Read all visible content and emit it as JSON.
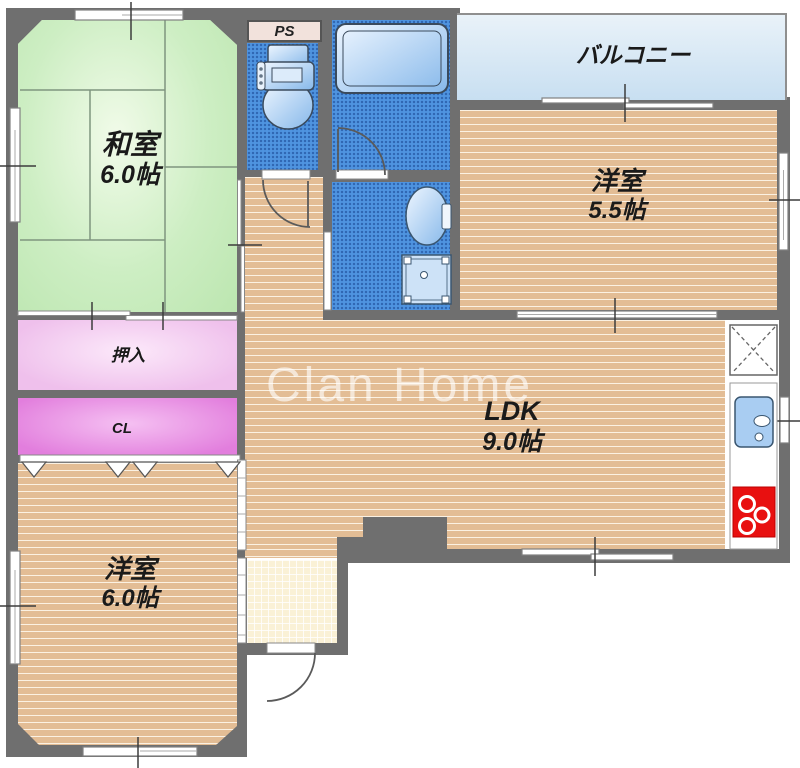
{
  "floorplan": {
    "watermark": "Clan Home",
    "balcony": {
      "label": "バルコニー"
    },
    "rooms": {
      "washitsu": {
        "label": "和室",
        "size": "6.0帖"
      },
      "youshitsu_upper": {
        "label": "洋室",
        "size": "5.5帖"
      },
      "youshitsu_lower": {
        "label": "洋室",
        "size": "6.0帖"
      },
      "ldk": {
        "label": "LDK",
        "size": "9.0帖"
      },
      "oshiire": {
        "label": "押入"
      },
      "closet": {
        "label": "CL"
      },
      "pipe_space": {
        "label": "PS"
      }
    },
    "colors": {
      "wall": "#6f6f6f",
      "tatami_green": "#cdeec3",
      "wood_floor": "#e3bd95",
      "closet_pink": "#efc0ec",
      "cl_magenta": "#e27edd",
      "wet_area_blue": "#4f94e0",
      "balcony_blue": "#d6e8f6",
      "genkan_cream": "#faf1d6",
      "stove_red": "#e81010",
      "fixture_blue": "#b8d8f4"
    }
  }
}
